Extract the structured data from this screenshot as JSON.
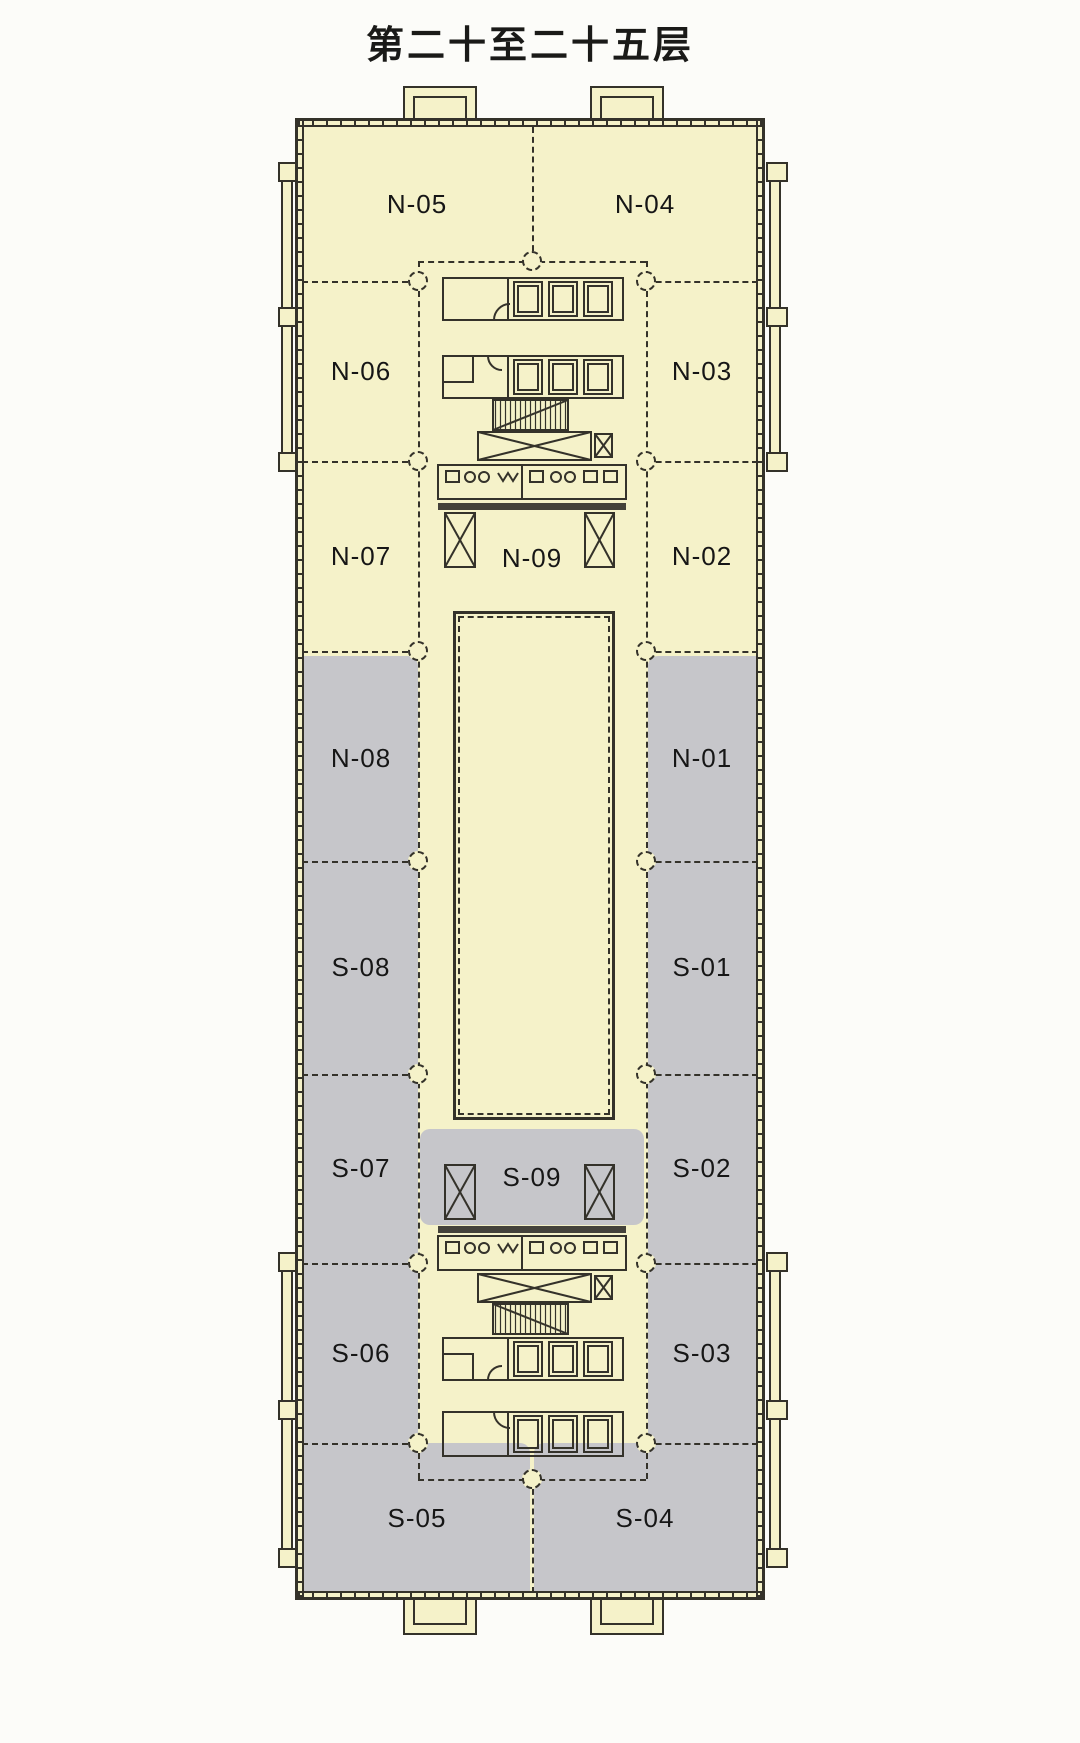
{
  "title": "第二十至二十五层",
  "colors": {
    "unit_fill": "#F5F2C9",
    "shaded_unit_fill": "#C6C6CA",
    "line": "#34322A",
    "page_background": "#FCFCF9"
  },
  "floor_plan": {
    "units": [
      {
        "id": "N-05",
        "label": "N-05",
        "shaded": false
      },
      {
        "id": "N-04",
        "label": "N-04",
        "shaded": false
      },
      {
        "id": "N-06",
        "label": "N-06",
        "shaded": false
      },
      {
        "id": "N-03",
        "label": "N-03",
        "shaded": false
      },
      {
        "id": "N-07",
        "label": "N-07",
        "shaded": false
      },
      {
        "id": "N-09",
        "label": "N-09",
        "shaded": false
      },
      {
        "id": "N-02",
        "label": "N-02",
        "shaded": false
      },
      {
        "id": "N-08",
        "label": "N-08",
        "shaded": true
      },
      {
        "id": "N-01",
        "label": "N-01",
        "shaded": true
      },
      {
        "id": "S-08",
        "label": "S-08",
        "shaded": true
      },
      {
        "id": "S-01",
        "label": "S-01",
        "shaded": true
      },
      {
        "id": "S-07",
        "label": "S-07",
        "shaded": true
      },
      {
        "id": "S-09",
        "label": "S-09",
        "shaded": true
      },
      {
        "id": "S-02",
        "label": "S-02",
        "shaded": true
      },
      {
        "id": "S-06",
        "label": "S-06",
        "shaded": true
      },
      {
        "id": "S-03",
        "label": "S-03",
        "shaded": true
      },
      {
        "id": "S-05",
        "label": "S-05",
        "shaded": true
      },
      {
        "id": "S-04",
        "label": "S-04",
        "shaded": true
      }
    ]
  }
}
